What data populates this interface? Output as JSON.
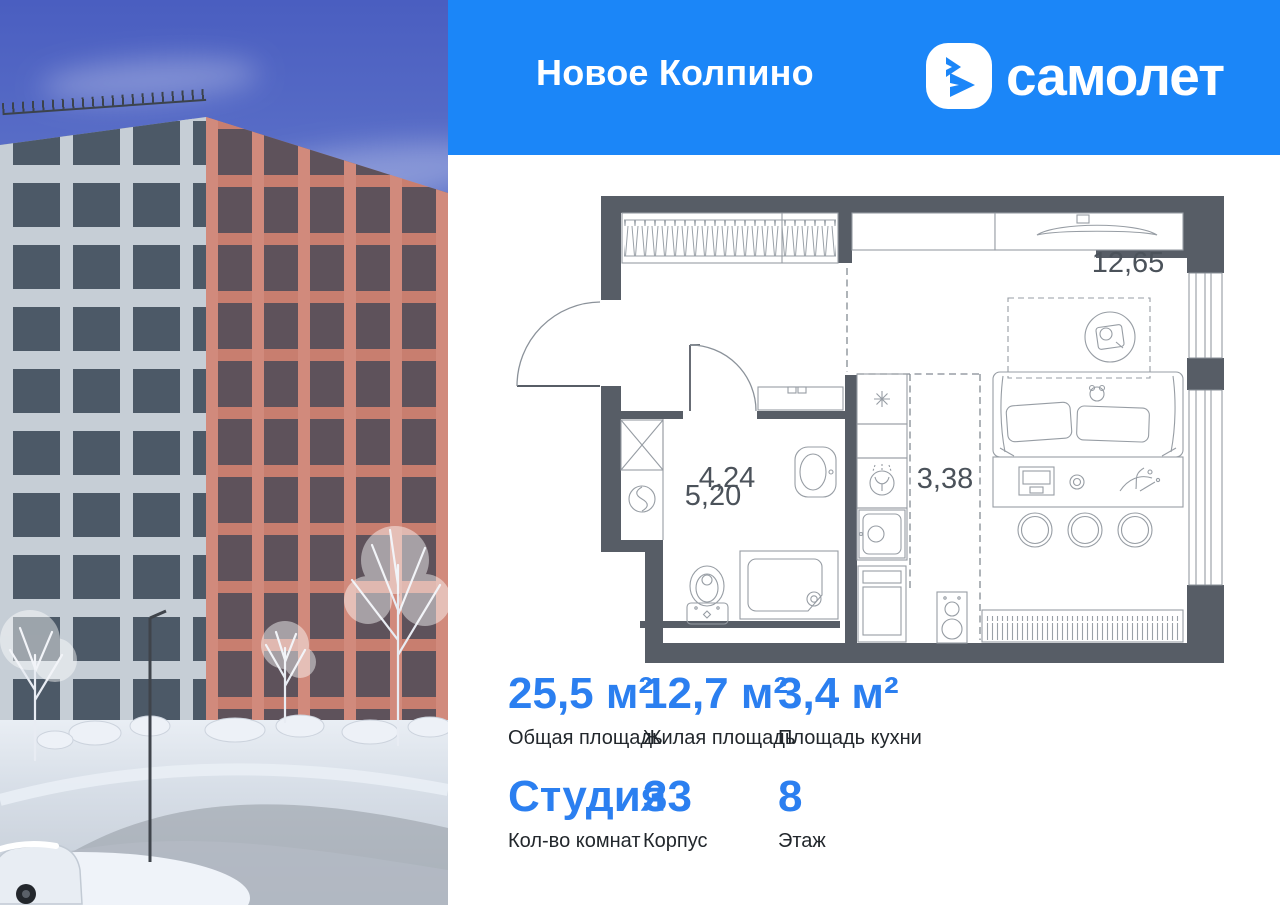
{
  "header": {
    "project_name": "Новое Колпино",
    "brand_wordmark": "самолет"
  },
  "floor_plan": {
    "rooms": [
      {
        "name": "hallway",
        "area": "5,20"
      },
      {
        "name": "living-room",
        "area": "12,65"
      },
      {
        "name": "bathroom",
        "area": "4,24"
      },
      {
        "name": "kitchen",
        "area": "3,38"
      }
    ]
  },
  "stats": {
    "cells": [
      {
        "value": "25,5 м²",
        "label": "Общая площадь"
      },
      {
        "value": "12,7 м²",
        "label": "Жилая площадь"
      },
      {
        "value": "3,4 м²",
        "label": "Площадь кухни"
      },
      {
        "value": "Студия",
        "label": "Кол-во комнат"
      },
      {
        "value": "33",
        "label": "Корпус"
      },
      {
        "value": "8",
        "label": "Этаж"
      }
    ]
  },
  "colors": {
    "brand_blue": "#1b86f8",
    "stat_number_blue": "#2b7ff0",
    "plan_wall_gray": "#575d66"
  }
}
